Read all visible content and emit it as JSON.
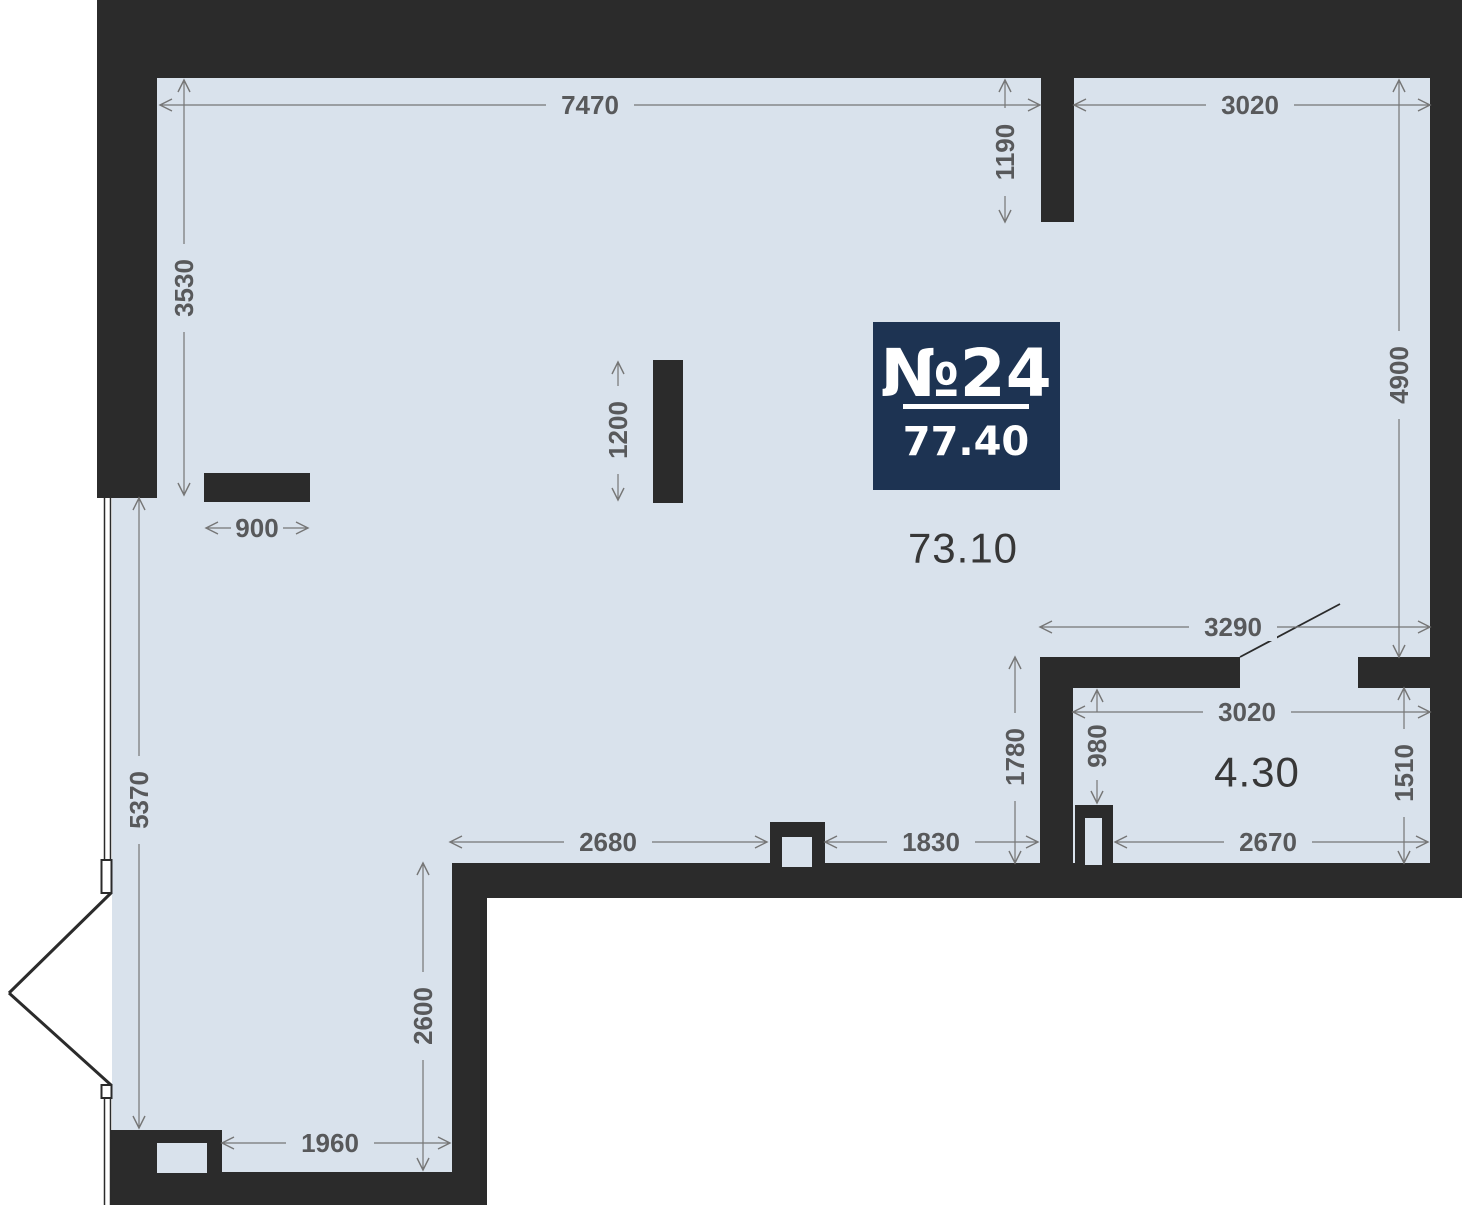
{
  "unit": {
    "number": "№24",
    "total_area": "77.40"
  },
  "areas": {
    "main_room": "73.10",
    "bathroom": "4.30"
  },
  "dimensions_mm": {
    "top_left_width": "7470",
    "top_right_width": "3020",
    "entry_niche_depth": "1190",
    "upper_left_height": "3530",
    "right_side_height": "4900",
    "column_length": "1200",
    "ledge_width": "900",
    "lower_left_height": "5370",
    "hall_opening_width": "3290",
    "hall_height": "1780",
    "niche_height": "980",
    "bathroom_width": "3020",
    "bathroom_height": "1510",
    "bottom_left_span": "2680",
    "bottom_middle_span": "1830",
    "bathroom_bottom_span": "2670",
    "lower_area_height": "2600",
    "bottom_width": "1960"
  },
  "colors": {
    "wall": "#2b2b2b",
    "floor": "#d9e2ec",
    "badge_bg": "#1d3352",
    "dim_line": "#767676",
    "dim_text": "#58595b",
    "area_text": "#373737",
    "outside": "#ffffff"
  }
}
